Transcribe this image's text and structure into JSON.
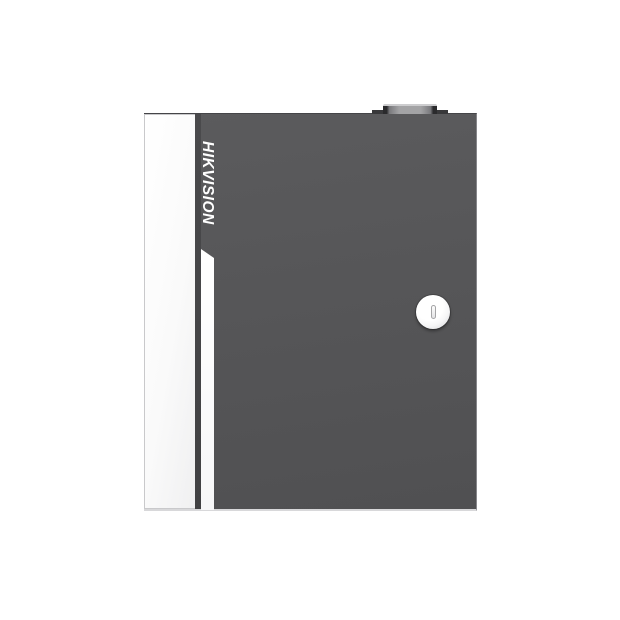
{
  "image": {
    "type": "product-photo",
    "subject": "Wall-mount metal enclosure access controller with cam lock, viewed from front",
    "background_color": "#ffffff"
  },
  "device": {
    "brand_label": "HIKVISION",
    "colors": {
      "body": "#565658",
      "body_edge_dark": "#454548",
      "side_panel": "#fafafa",
      "accent_stripe": "#ffffff",
      "lock_face": "#ffffff",
      "keyhole": "#e9e9eb",
      "hinge_dark": "#2a2a2c",
      "hinge_metal": "#a3a3a5",
      "bottom_lip": "#d8d8da"
    }
  }
}
